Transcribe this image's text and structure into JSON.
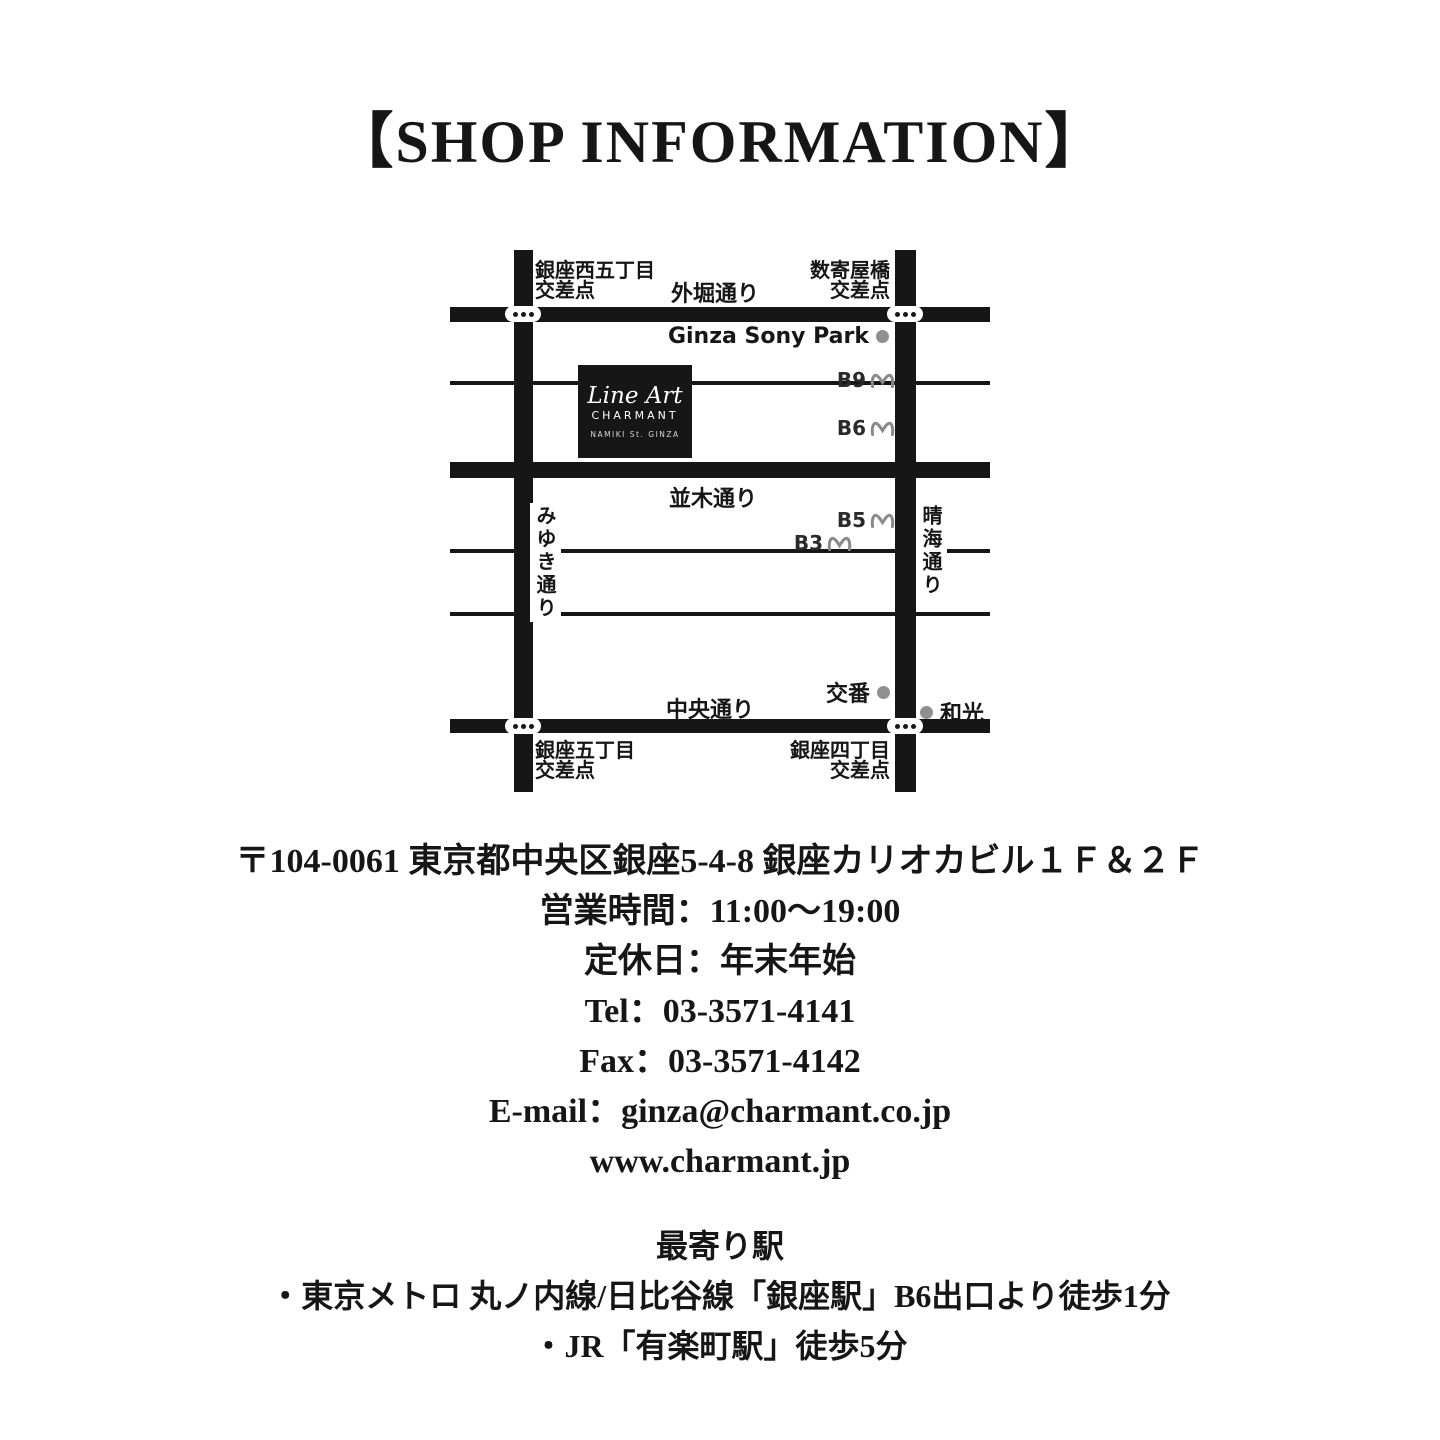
{
  "title": "【SHOP INFORMATION】",
  "map": {
    "logo": {
      "brand_script": "Line Art",
      "brand_name": "CHARMANT",
      "brand_sub": "NAMIKI St. GINZA"
    },
    "streets": {
      "sotobori": "外堀通り",
      "namiki": "並木通り",
      "chuo": "中央通り",
      "miyuki": "みゆき通り",
      "harumi": "晴海通り"
    },
    "intersections": {
      "nw": [
        "銀座西五丁目",
        "交差点"
      ],
      "ne": [
        "数寄屋橋",
        "交差点"
      ],
      "sw": [
        "銀座五丁目",
        "交差点"
      ],
      "se": [
        "銀座四丁目",
        "交差点"
      ]
    },
    "landmarks": {
      "sony_park": "Ginza Sony Park",
      "koban": "交番",
      "wako": "和光"
    },
    "exits": [
      "B9",
      "B6",
      "B5",
      "B3"
    ]
  },
  "info": {
    "address": "〒104-0061 東京都中央区銀座5-4-8 銀座カリオカビル１Ｆ＆２Ｆ",
    "hours": "営業時間：11:00～19:00",
    "holiday": "定休日：年末年始",
    "tel": "Tel：03-3571-4141",
    "fax": "Fax：03-3571-4142",
    "email": "E-mail：ginza@charmant.co.jp",
    "website": "www.charmant.jp"
  },
  "stations": {
    "heading": "最寄り駅",
    "lines": [
      "・東京メトロ 丸ノ内線/日比谷線「銀座駅」B6出口より徒歩1分",
      "・JR「有楽町駅」徒歩5分"
    ]
  },
  "colors": {
    "ink": "#161616",
    "gray_dot": "#8f8f8f",
    "metro_gray": "#8a8a8a",
    "background": "#ffffff"
  }
}
